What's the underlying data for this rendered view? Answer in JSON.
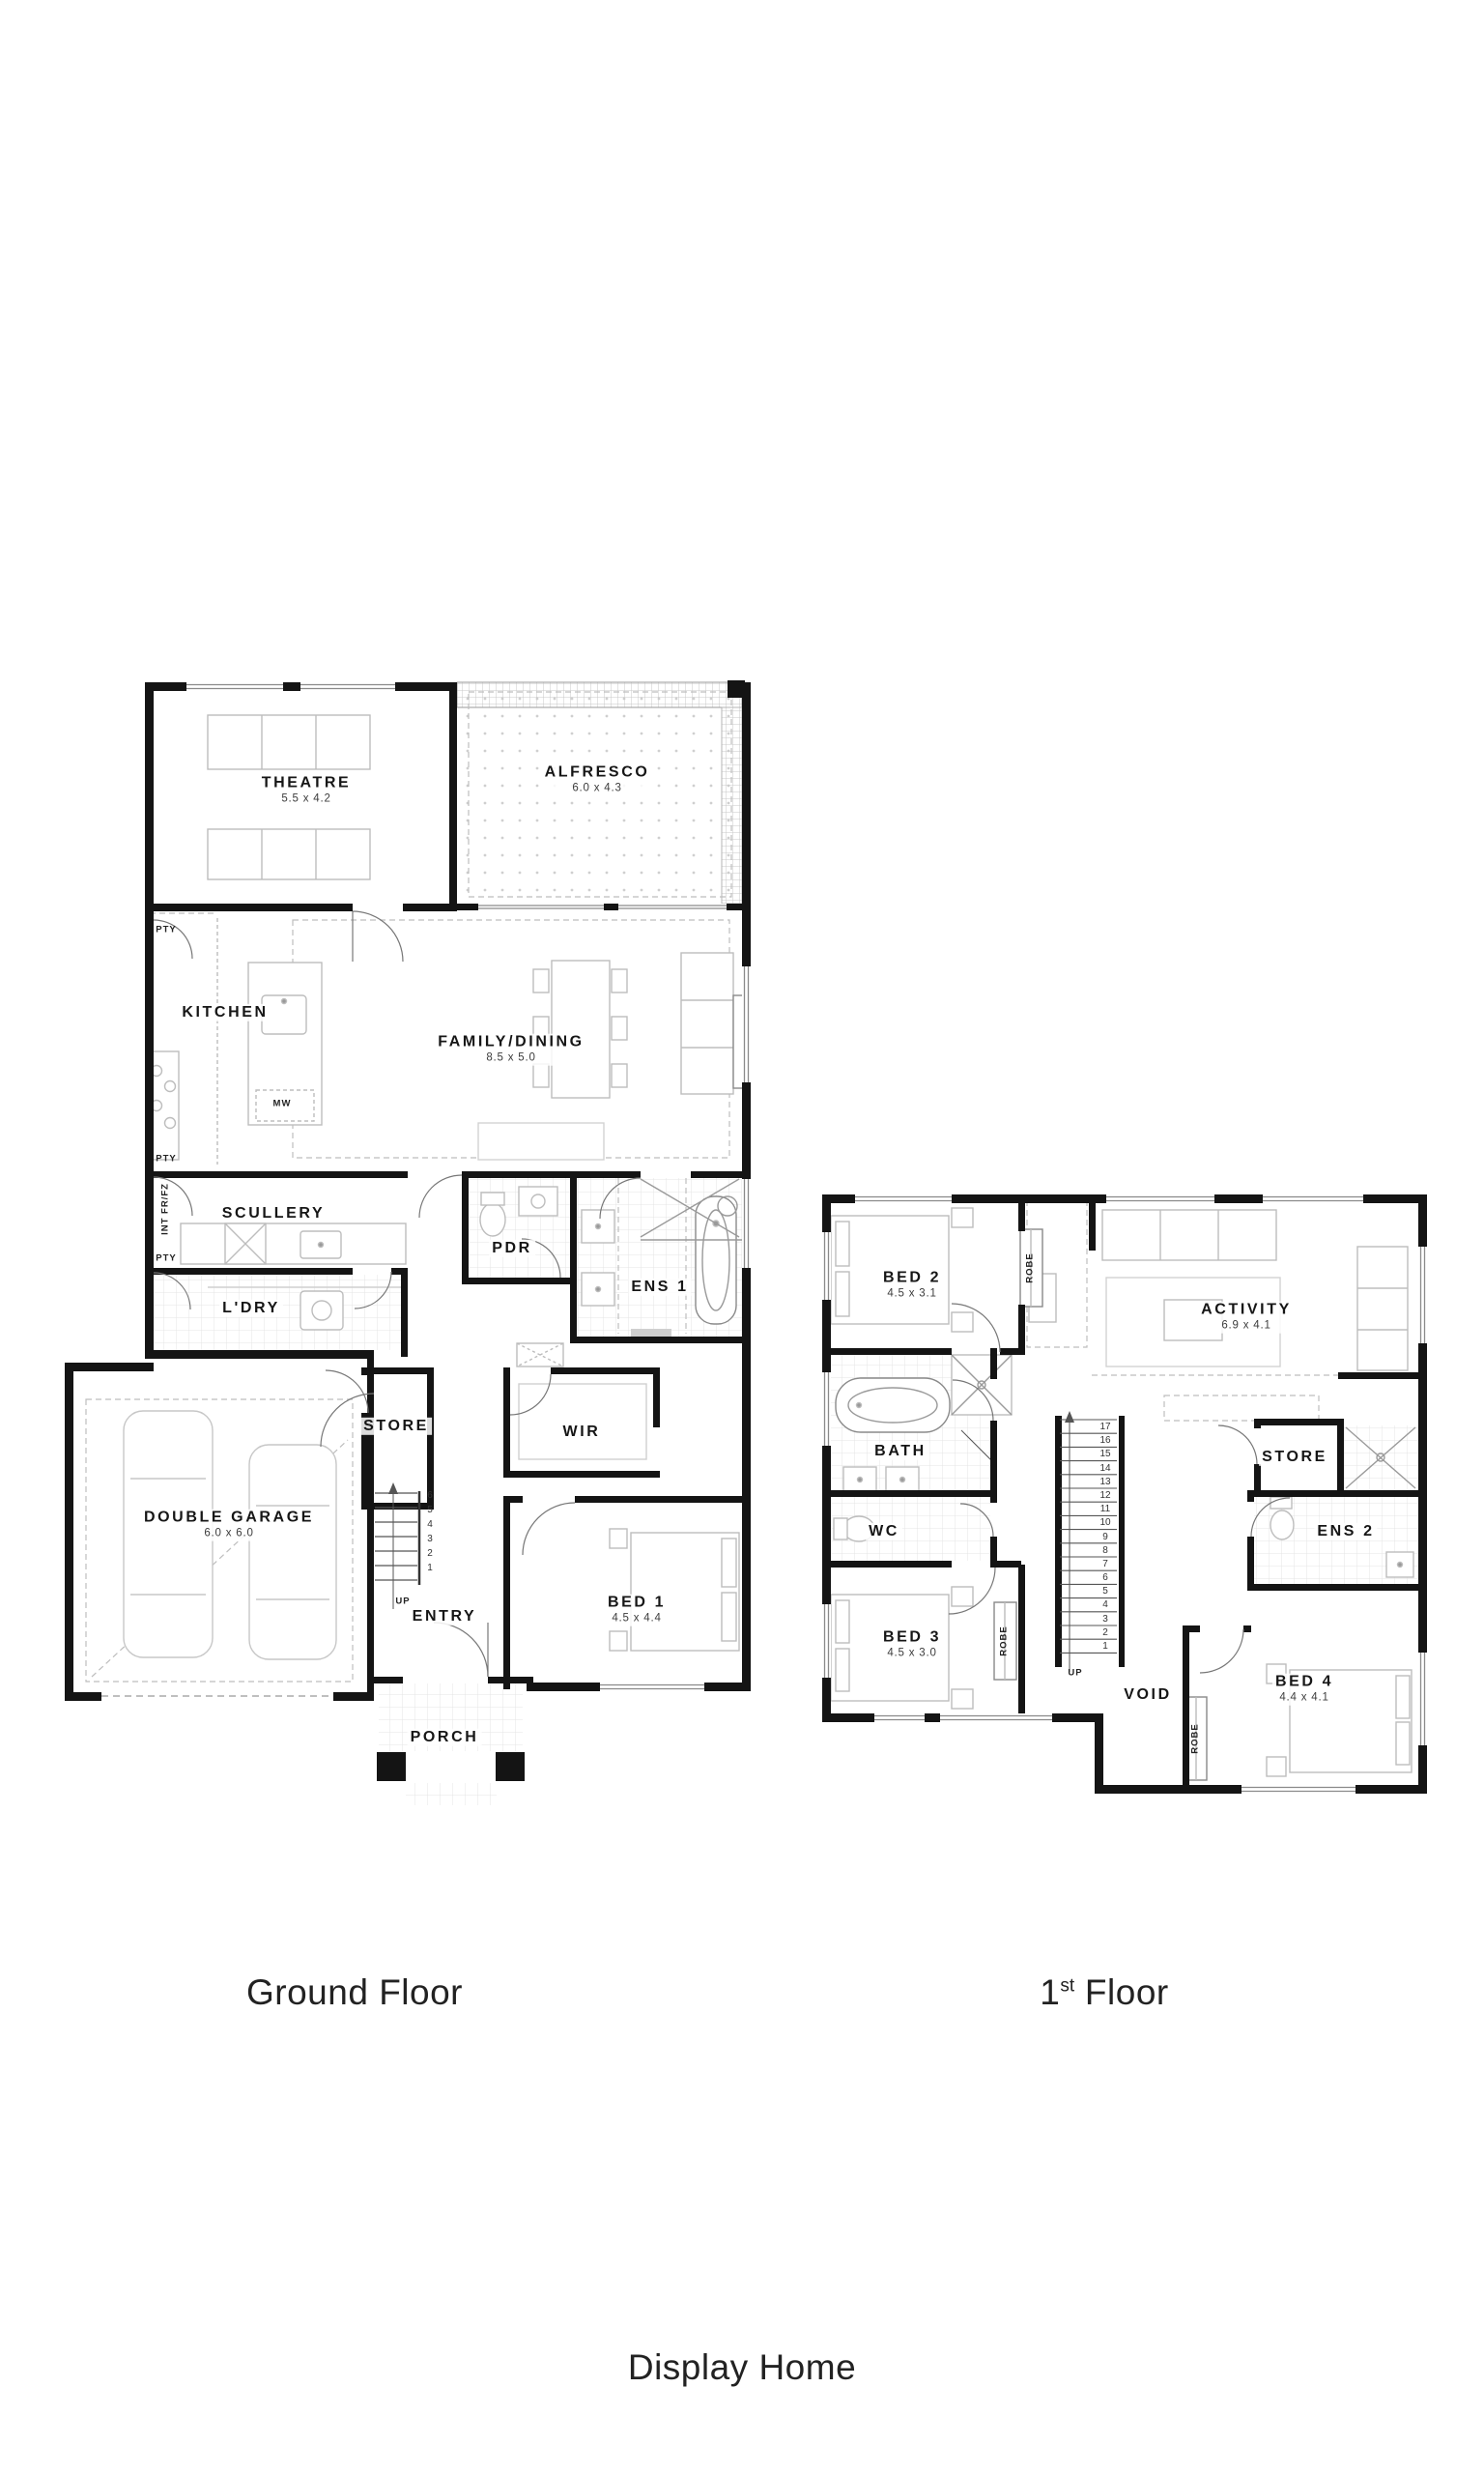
{
  "captions": {
    "ground": "Ground Floor",
    "first_num": "1",
    "first_sup": "st",
    "first_rest": " Floor",
    "footer": "Display Home"
  },
  "colors": {
    "wall": "#141414",
    "furniture": "#bdbdbd",
    "tile": "#e4e4e4",
    "accent_text": "#161616"
  },
  "ground": {
    "theatre": {
      "name": "THEATRE",
      "dims": "5.5 x 4.2"
    },
    "alfresco": {
      "name": "ALFRESCO",
      "dims": "6.0 x 4.3"
    },
    "kitchen": {
      "name": "KITCHEN"
    },
    "family": {
      "name": "FAMILY/DINING",
      "dims": "8.5 x 5.0"
    },
    "scullery": {
      "name": "SCULLERY"
    },
    "pdr": {
      "name": "PDR"
    },
    "ens1": {
      "name": "ENS 1"
    },
    "ldry": {
      "name": "L'DRY"
    },
    "store": {
      "name": "STORE"
    },
    "wir": {
      "name": "WIR"
    },
    "garage": {
      "name": "DOUBLE GARAGE",
      "dims": "6.0 x 6.0"
    },
    "entry": {
      "name": "ENTRY"
    },
    "bed1": {
      "name": "BED 1",
      "dims": "4.5 x 4.4"
    },
    "porch": {
      "name": "PORCH"
    },
    "mw": "MW",
    "pty": "PTY",
    "int_fr": "INT FR/FZ",
    "up": "UP",
    "stairs": [
      "6",
      "5",
      "4",
      "3",
      "2",
      "1"
    ]
  },
  "first": {
    "bed2": {
      "name": "BED 2",
      "dims": "4.5 x 3.1"
    },
    "activity": {
      "name": "ACTIVITY",
      "dims": "6.9 x 4.1"
    },
    "bath": {
      "name": "BATH"
    },
    "wc": {
      "name": "WC"
    },
    "store": {
      "name": "STORE"
    },
    "ens2": {
      "name": "ENS 2"
    },
    "bed3": {
      "name": "BED 3",
      "dims": "4.5 x 3.0"
    },
    "bed4": {
      "name": "BED 4",
      "dims": "4.4 x 4.1"
    },
    "void": {
      "name": "VOID"
    },
    "robe": "ROBE",
    "up": "UP",
    "stairs": [
      "17",
      "16",
      "15",
      "14",
      "13",
      "12",
      "11",
      "10",
      "9",
      "8",
      "7",
      "6",
      "5",
      "4",
      "3",
      "2",
      "1"
    ]
  }
}
